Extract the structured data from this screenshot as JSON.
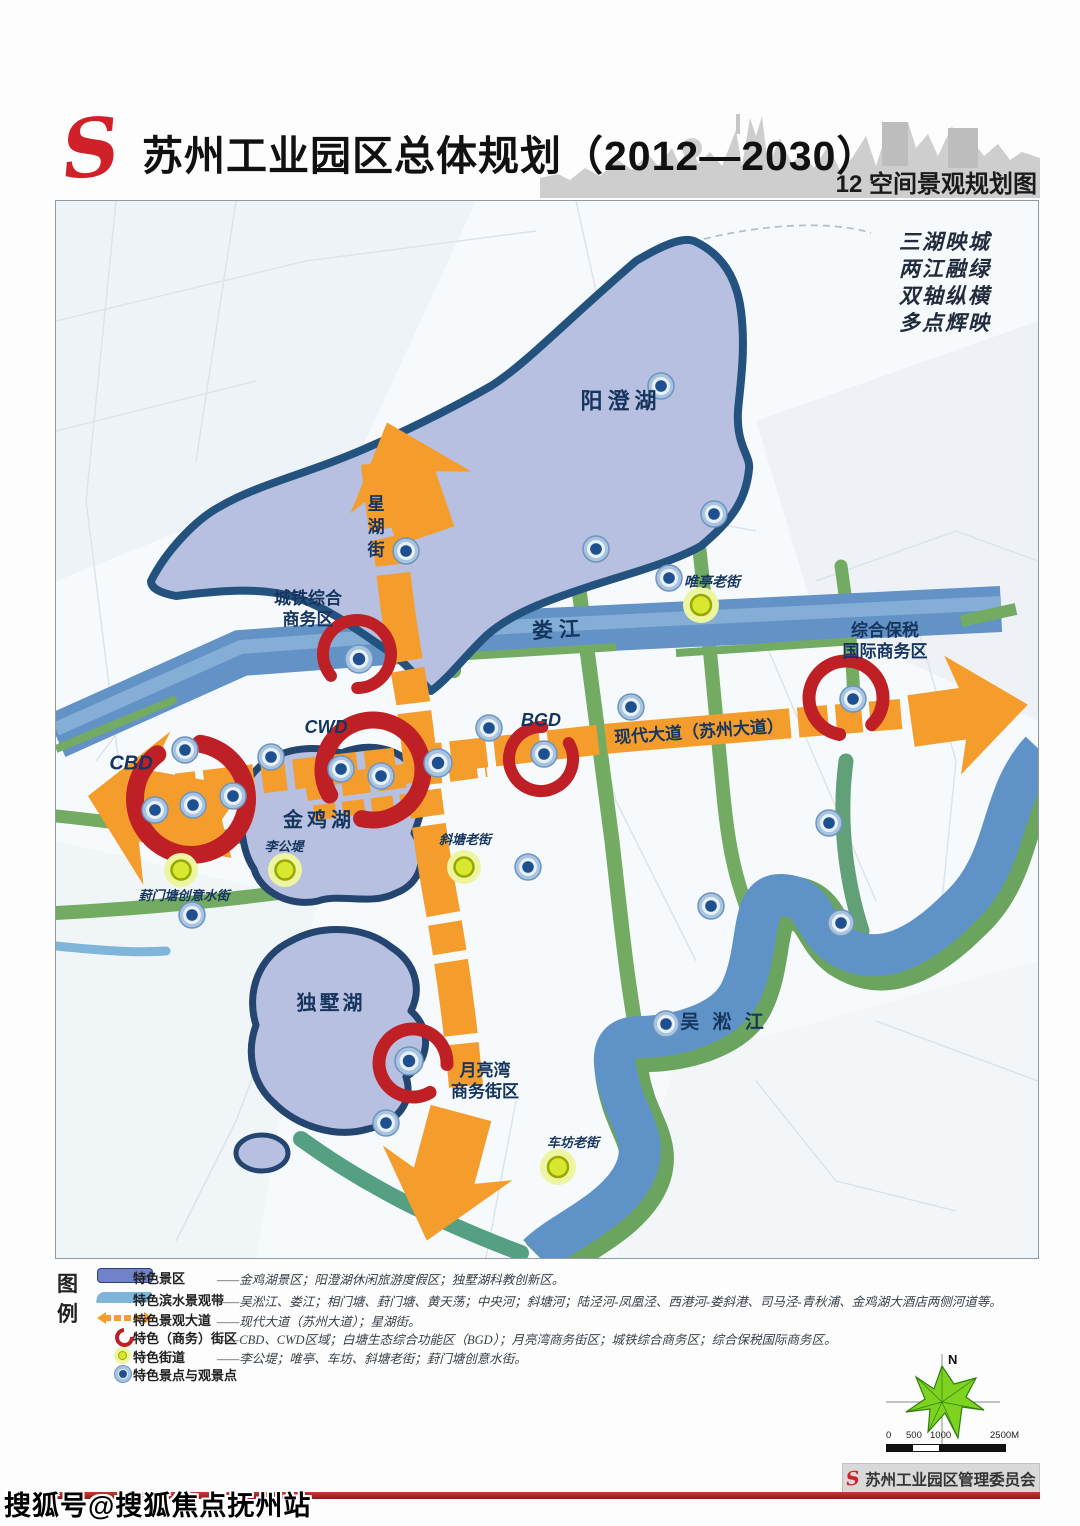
{
  "header": {
    "logo": "S",
    "title": "苏州工业园区总体规划（2012—2030）",
    "subtitle": "12 空间景观规划图"
  },
  "map": {
    "motto": "三湖映城\n两江融绿\n双轴纵横\n多点辉映",
    "labels": {
      "yangcheng_lake": "阳澄湖",
      "xinghu_street": "星湖街",
      "chengtie_hub": "城铁综合\n商务区",
      "loujiang_river": "娄  江",
      "weiting_street": "唯亭老街",
      "zonghe_baoshui": "综合保税\n国际商务区",
      "cbd": "CBD",
      "cwd": "CWD",
      "bgd": "BGD",
      "xiandai_avenue": "现代大道（苏州大道）",
      "jinji_lake": "金鸡湖",
      "ligongdi": "李公堤",
      "xietang_street": "斜塘老街",
      "fengmentang_street": "葑门塘创意水街",
      "dushu_lake": "独墅湖",
      "yueliangwan": "月亮湾\n商务街区",
      "chefang_street": "车坊老街",
      "wusong_river": "吴 淞 江"
    }
  },
  "legend": {
    "heading": "图\n例",
    "items": [
      {
        "term": "特色景区",
        "desc": "——金鸡湖景区；阳澄湖休闲旅游度假区；独墅湖科教创新区。"
      },
      {
        "term": "特色滨水景观带",
        "desc": "——吴淞江、娄江；相门塘、葑门塘、黄天荡；中央河；斜塘河；陆泾河-凤凰泾、西港河-娄斜港、司马泾-青秋浦、金鸡湖大酒店两侧河道等。"
      },
      {
        "term": "特色景观大道",
        "desc": "——现代大道（苏州大道）；星湖街。"
      },
      {
        "term": "特色（商务）街区",
        "desc": "——CBD、CWD区域；白塘生态综合功能区（BGD）；月亮湾商务街区；城铁综合商务区；综合保税国际商务区。"
      },
      {
        "term": "特色街道",
        "desc": "——李公堤；唯亭、车坊、斜塘老街；葑门塘创意水街。"
      },
      {
        "term": "特色景点与观景点",
        "desc": ""
      }
    ]
  },
  "compass": {
    "north_label": "N"
  },
  "scalebar": {
    "ticks": [
      "0",
      "500",
      "1000",
      "2500M"
    ]
  },
  "footer": {
    "stamp_logo": "S",
    "stamp_text": "苏州工业园区管理委员会"
  },
  "watermark": "搜狐号@搜狐焦点抚州站",
  "colors": {
    "axis_orange": "#f49d2c",
    "ring_red": "#bf2026",
    "lake_fill": "#b7c0e0",
    "lake_outline": "#24527f",
    "river_blue": "#5f93c7",
    "greenway": "#6fa75f",
    "street_yellow": "#d8e830",
    "point_navy": "#1e4f8f",
    "logo_red": "#d02028"
  }
}
